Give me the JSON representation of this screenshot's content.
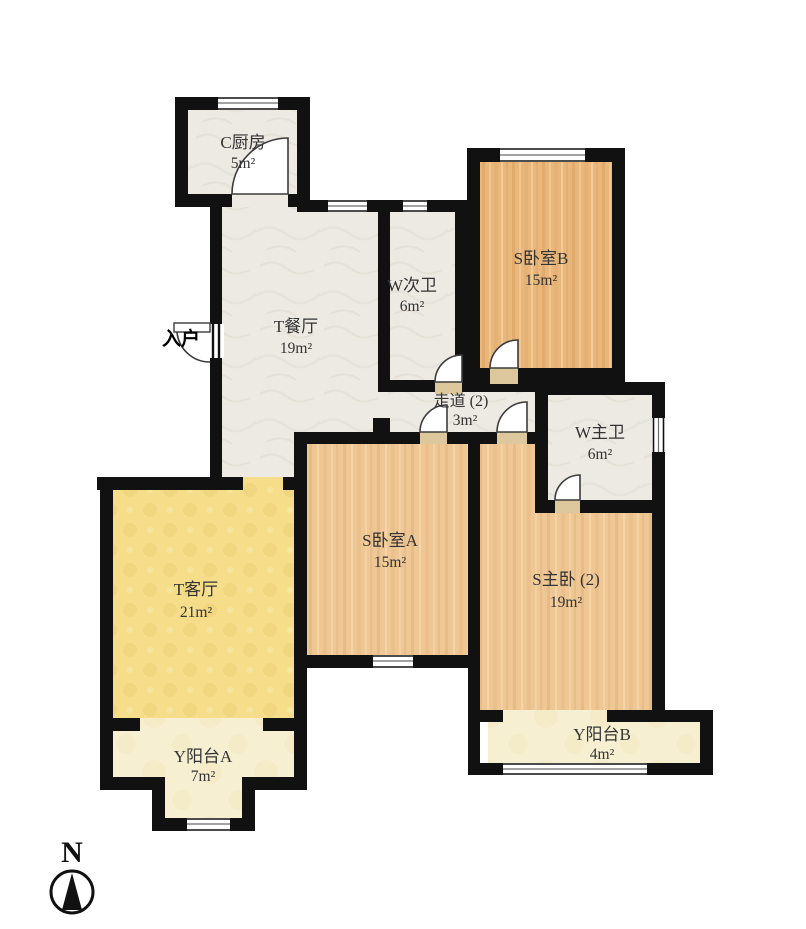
{
  "plan": {
    "entrance_label": "入户",
    "compass_label": "N"
  },
  "rooms": {
    "kitchen": {
      "name": "C厨房",
      "area": "5m²"
    },
    "dining": {
      "name": "T餐厅",
      "area": "19m²"
    },
    "bath2": {
      "name": "W次卫",
      "area": "6m²"
    },
    "bedroomB": {
      "name": "S卧室B",
      "area": "15m²"
    },
    "corridor": {
      "name": "走道 (2)",
      "area": "3m²"
    },
    "bathMaster": {
      "name": "W主卫",
      "area": "6m²"
    },
    "living": {
      "name": "T客厅",
      "area": "21m²"
    },
    "bedroomA": {
      "name": "S卧室A",
      "area": "15m²"
    },
    "master": {
      "name": "S主卧 (2)",
      "area": "19m²"
    },
    "balconyA": {
      "name": "Y阳台A",
      "area": "7m²"
    },
    "balconyB": {
      "name": "Y阳台B",
      "area": "4m²"
    }
  },
  "colors": {
    "wall": "#111111",
    "marble_floor": "#edeae3",
    "wood_floor_a": "#eec795",
    "wood_floor_b": "#e9b77c",
    "living_floor": "#f5dd8a",
    "balcony_floor": "#f7efd2",
    "label_text": "#333333"
  }
}
